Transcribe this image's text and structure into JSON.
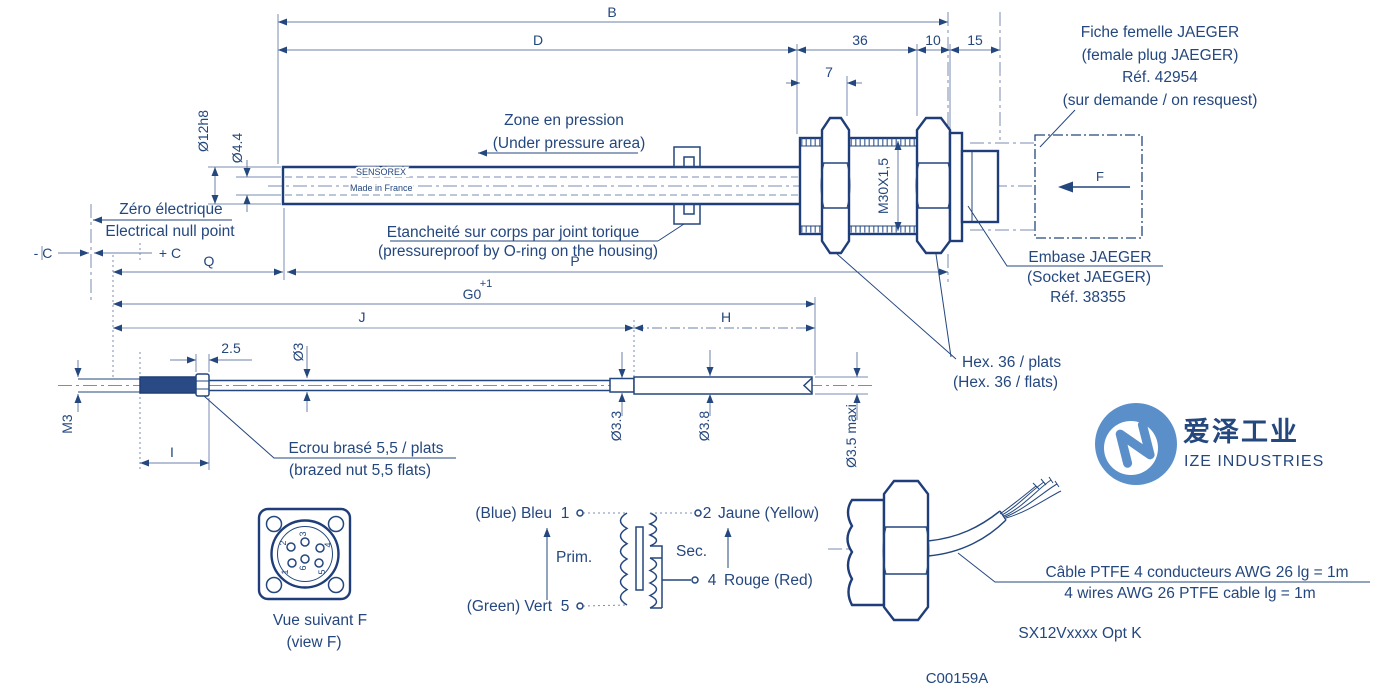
{
  "colors": {
    "line_navy": "#1f3e79",
    "dim_blue": "#6c80a8",
    "logo_blue": "#5b8fc9",
    "logo_text_dark": "#4f555e",
    "logo_text_gray": "#9aa1aa",
    "background": "#ffffff"
  },
  "upper": {
    "b": "B",
    "d": "D",
    "n36": "36",
    "n10": "10",
    "n15": "15",
    "n7": "7",
    "m30": "M30X1,5",
    "dia12": "Ø12h8",
    "dia44": "Ø4.4",
    "minus_c": "- C",
    "plus_c": "+ C",
    "q": "Q",
    "p": "P",
    "plus1": "+1",
    "g0": "G0",
    "j": "J",
    "h": "H",
    "f": "F",
    "zone_fr": "Zone en pression",
    "zone_en": "(Under pressure area)",
    "zero_fr": "Zéro électrique",
    "zero_en": "Electrical null point",
    "seal_fr": "Etancheité sur corps par joint torique",
    "seal_en": "(pressureproof by O-ring on the housing)",
    "brand": "SENSOREX",
    "made_in": "Made in France",
    "plug1": "Fiche femelle JAEGER",
    "plug2": "(female plug JAEGER)",
    "plug3": "Réf. 42954",
    "plug4": "(sur demande / on resquest)",
    "socket1": "Embase JAEGER",
    "socket2": "(Socket JAEGER)",
    "socket3": "Réf. 38355",
    "hex_fr": "Hex. 36 / plats",
    "hex_en": "(Hex. 36 / flats)"
  },
  "rod": {
    "m3": "M3",
    "n25": "2.5",
    "dia3": "Ø3",
    "i": "I",
    "dia33": "Ø3.3",
    "dia38": "Ø3.8",
    "dia35": "Ø3.5 maxi",
    "nut_fr": "Ecrou brasé 5,5 / plats",
    "nut_en": "(brazed nut 5,5 flats)"
  },
  "conn": {
    "p1": "1",
    "p2": "2",
    "p3": "3",
    "p4": "4",
    "p5": "5",
    "p6": "6",
    "cap_fr": "Vue suivant F",
    "cap_en": "(view F)"
  },
  "wiring": {
    "blue": "(Blue) Bleu",
    "n1": "1",
    "n2": "2",
    "yellow": "Jaune (Yellow)",
    "prim": "Prim.",
    "sec": "Sec.",
    "n4": "4",
    "red": "Rouge (Red)",
    "green": "(Green) Vert",
    "n5": "5"
  },
  "cable": {
    "fr": "Câble PTFE 4 conducteurs AWG 26 lg = 1m",
    "en": "4 wires AWG 26 PTFE cable lg = 1m",
    "model": "SX12Vxxxx Opt K"
  },
  "footer": {
    "ref": "C00159A"
  },
  "logo": {
    "cn": "爱泽工业",
    "en": "IZE INDUSTRIES"
  }
}
